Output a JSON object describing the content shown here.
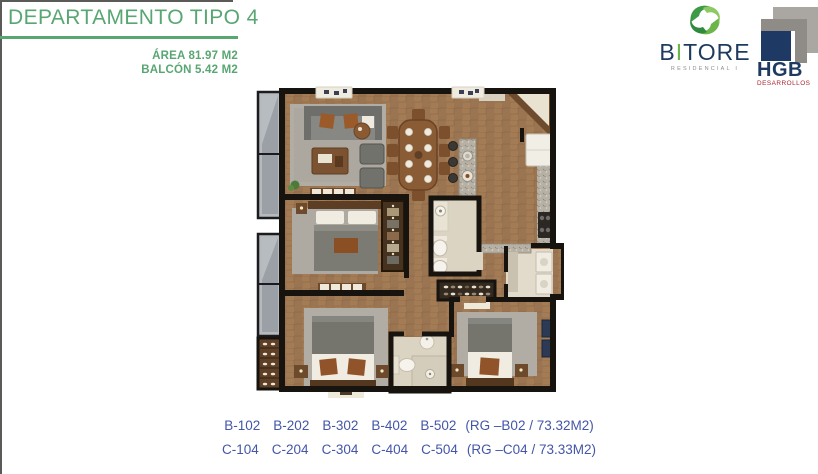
{
  "page": {
    "title": "DEPARTAMENTO TIPO 4"
  },
  "specs": {
    "area": "ÁREA 81.97  M2",
    "balcony": "BALCÓN 5.42 M2"
  },
  "logos": {
    "bitore": {
      "b": "B",
      "i": "I",
      "rest": "TORE",
      "tagline": "RESIDENCIAL I"
    },
    "hgb": {
      "name": "HGB",
      "tagline": "DESARROLLOS"
    }
  },
  "footer": {
    "rows": [
      {
        "units": [
          "B-102",
          "B-202",
          "B-302",
          "B-402",
          "B-502"
        ],
        "note": "(RG –B02 / 73.32M2)"
      },
      {
        "units": [
          "C-104",
          "C-204",
          "C-304",
          "C-404",
          "C-504"
        ],
        "note": "(RG –C04 / 73.33M2)"
      }
    ]
  },
  "colors": {
    "accent_green": "#58a672",
    "logo_green": "#6cb54a",
    "navy": "#1e3a5f",
    "unit_blue": "#4356a8",
    "tagline_red": "#ab2430"
  }
}
